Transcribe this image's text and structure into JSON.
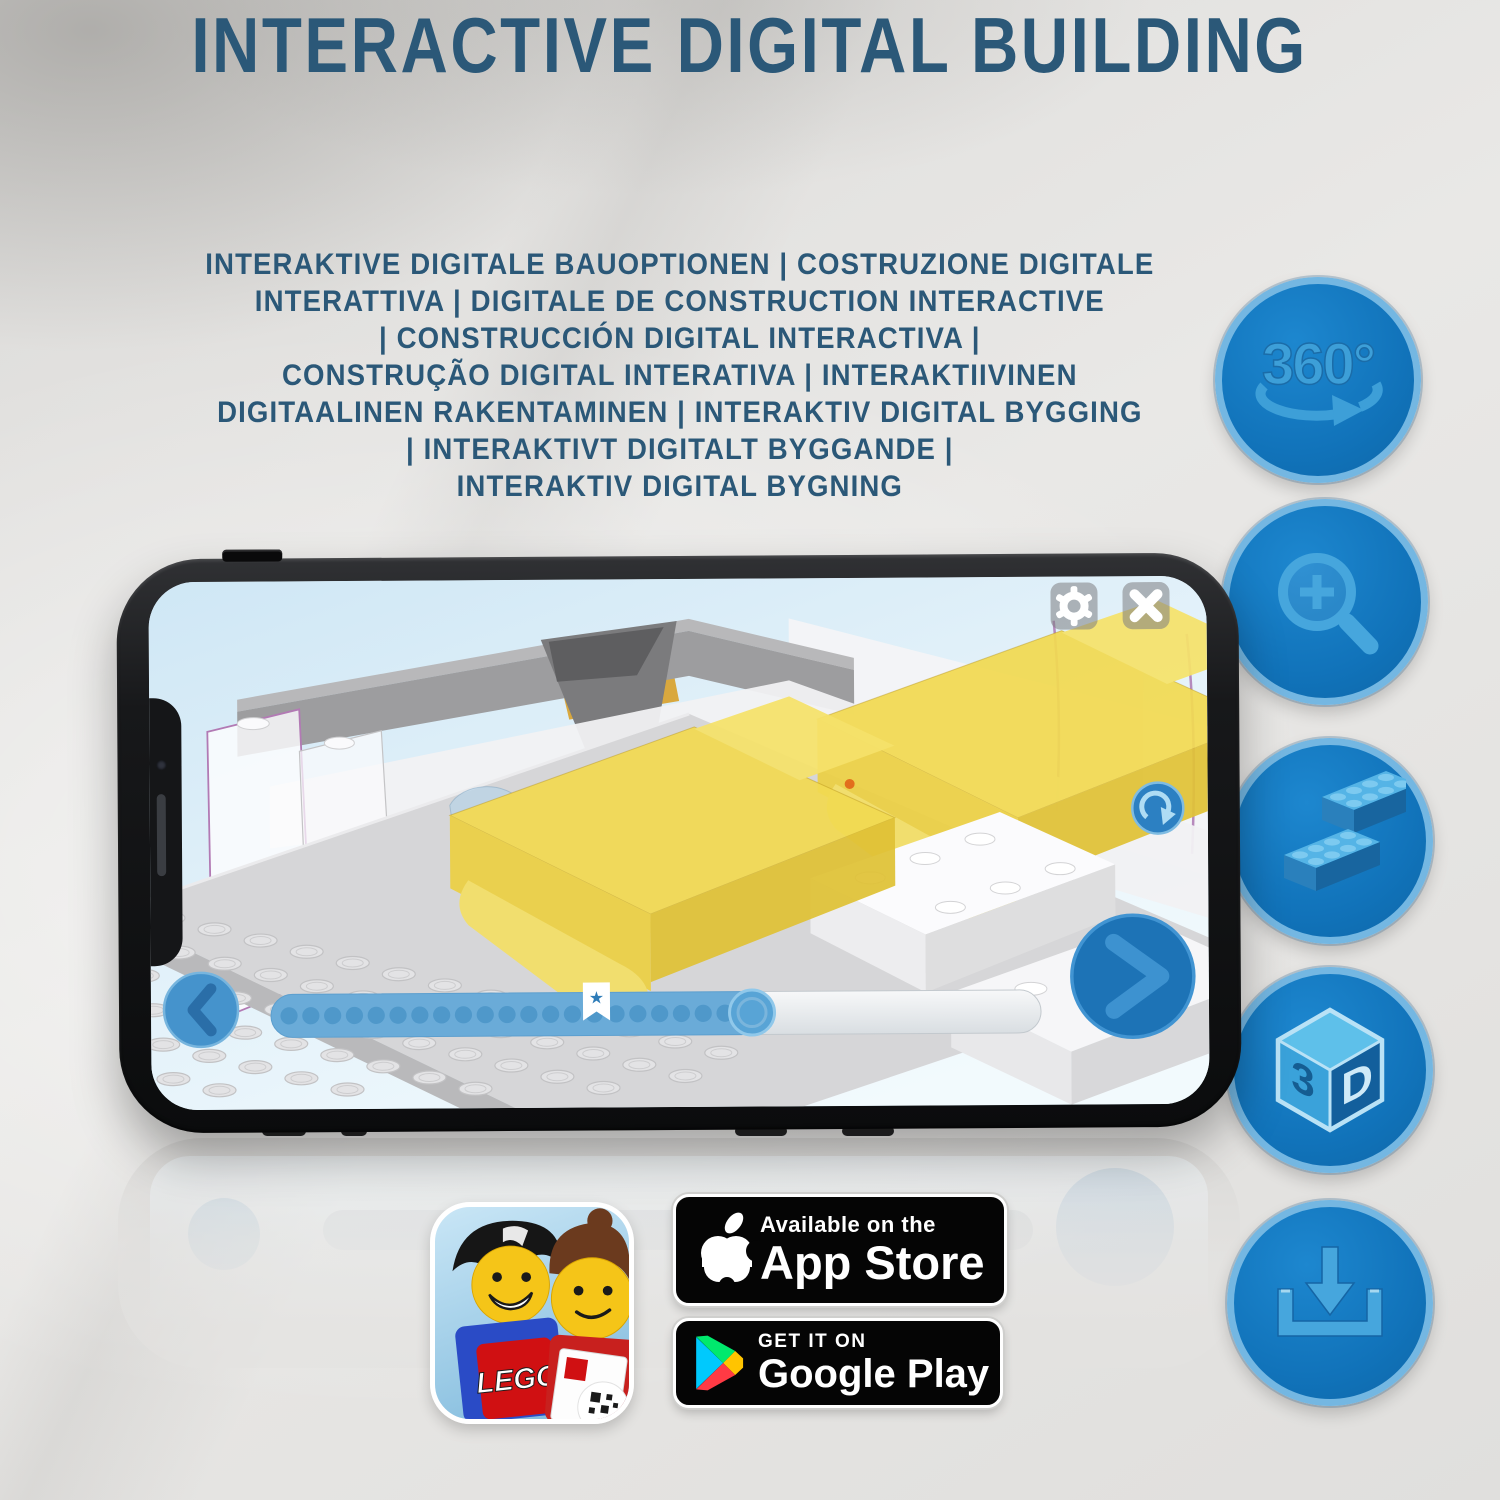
{
  "headline": "INTERACTIVE DIGITAL BUILDING",
  "subtitle_lines": [
    "INTERAKTIVE DIGITALE BAUOPTIONEN | COSTRUZIONE DIGITALE",
    "INTERATTIVA | DIGITALE DE CONSTRUCTION INTERACTIVE",
    "| CONSTRUCCIÓN DIGITAL INTERACTIVA |",
    "CONSTRUÇÃO DIGITAL INTERATIVA | INTERAKTIIVINEN",
    "DIGITAALINEN RAKENTAMINEN | INTERAKTIV DIGITAL BYGGING",
    "| INTERAKTIVT DIGITALT BYGGANDE |",
    "INTERAKTIV DIGITAL BYGNING"
  ],
  "feature_icons": {
    "rotation_label": "360°",
    "cube_left_face": "3",
    "cube_right_face": "D"
  },
  "phone_app": {
    "progress_dots": 21,
    "bookmark_star": "★"
  },
  "badges": {
    "lego_app_logo": "LEGO",
    "app_store": {
      "tagline": "Available on the",
      "name": "App Store"
    },
    "google_play": {
      "tagline": "GET IT ON",
      "name": "Google Play"
    }
  },
  "colors": {
    "headline_blue": "#2b5878",
    "circle_fill": "#1173ba",
    "circle_ring": "#74b7e2",
    "icon_blue": "#46a6dd",
    "bed_yellow": "#f2d94e",
    "app_blue": "#2e86c8"
  }
}
